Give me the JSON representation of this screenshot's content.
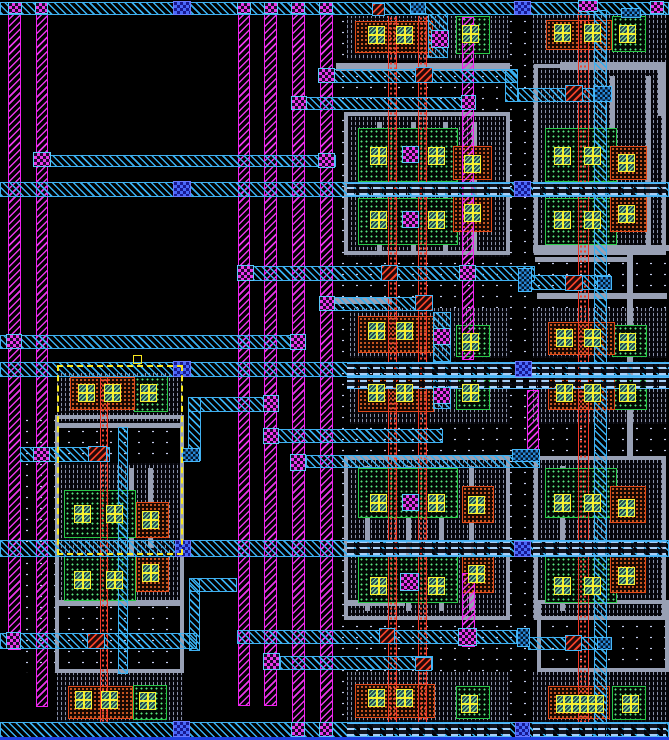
{
  "app": {
    "name": "ic-layout-editor-viewport",
    "tool": "vlsi-layout-canvas"
  },
  "canvas": {
    "width": 669,
    "height": 740,
    "background": "#000000"
  },
  "palette": {
    "metal1_magenta": "#e838e8",
    "metal2_cyan": "#38b0f0",
    "via12_checker": "#e838e8",
    "via_dark_blue": "#4868f8",
    "contact_red": "#f04028",
    "diff_contact_yellow": "#f8f030",
    "ndiff_green": "#58e880",
    "implant_orange": "#f06828",
    "poly_red": "#f04838",
    "gate_gray": "#98a0b4",
    "well_dot": "#c8d0f0",
    "selection_yellow": "#f8e820",
    "bottom_rail_blue": "#2040e0"
  },
  "legend": {
    "m1": "vertical metal1 power rail (magenta hatch)",
    "m2": "metal2 routing (cyan hatch)",
    "m2d": "metal2 over cell (dashed render)",
    "via-m": "metal1-metal2 via (magenta checker)",
    "via-b": "stacked via (dark blue checker)",
    "via-r": "poly contact via (red hatch)",
    "jbox": "metal junction box",
    "cont": "diffusion contact (yellow cross)",
    "diff": "n/p diffusion (green dots)",
    "imp": "implant region (orange dots)",
    "rpoly": "poly column (red dots)",
    "ptex": "gate poly texture",
    "gray": "gate/field structure",
    "well": "well stipple",
    "sel": "selection box (yellow dashed)"
  },
  "selection": {
    "x": 57,
    "y": 365,
    "w": 126,
    "h": 190,
    "handle": [
      133,
      355
    ]
  },
  "shapes": [
    [
      "well",
      336,
      16,
      333,
      706
    ],
    [
      "well",
      20,
      415,
      164,
      258
    ],
    [
      "ptex",
      347,
      16,
      163,
      44
    ],
    [
      "ptex",
      533,
      13,
      134,
      52
    ],
    [
      "ptex",
      347,
      112,
      163,
      145
    ],
    [
      "ptex",
      533,
      64,
      133,
      191
    ],
    [
      "ptex",
      350,
      308,
      160,
      50
    ],
    [
      "ptex",
      533,
      308,
      134,
      50
    ],
    [
      "ptex",
      350,
      377,
      160,
      47
    ],
    [
      "ptex",
      533,
      377,
      134,
      47
    ],
    [
      "ptex",
      347,
      456,
      163,
      164
    ],
    [
      "ptex",
      533,
      456,
      133,
      164
    ],
    [
      "ptex",
      347,
      672,
      163,
      50
    ],
    [
      "ptex",
      533,
      672,
      136,
      50
    ],
    [
      "ptex",
      57,
      373,
      126,
      50
    ],
    [
      "ptex",
      57,
      463,
      126,
      92
    ],
    [
      "ptex",
      57,
      555,
      126,
      47
    ],
    [
      "ptex",
      57,
      673,
      126,
      49
    ],
    [
      "grayframe",
      344,
      112,
      166,
      143
    ],
    [
      "gray",
      377,
      122,
      5,
      130
    ],
    [
      "gray",
      411,
      122,
      5,
      130
    ],
    [
      "gray",
      443,
      122,
      5,
      130
    ],
    [
      "gray",
      472,
      122,
      5,
      130
    ],
    [
      "grayframe",
      344,
      456,
      166,
      164
    ],
    [
      "gray",
      365,
      466,
      5,
      145
    ],
    [
      "gray",
      406,
      466,
      5,
      145
    ],
    [
      "gray",
      439,
      466,
      5,
      145
    ],
    [
      "gray",
      469,
      466,
      5,
      145
    ],
    [
      "grayframe",
      534,
      64,
      132,
      191
    ],
    [
      "gray",
      610,
      76,
      5,
      170
    ],
    [
      "gray",
      646,
      76,
      5,
      170
    ],
    [
      "grayframe",
      534,
      456,
      132,
      164
    ],
    [
      "gray",
      560,
      466,
      5,
      145
    ],
    [
      "gray",
      627,
      252,
      6,
      204
    ],
    [
      "gray",
      533,
      245,
      136,
      6
    ],
    [
      "gray",
      535,
      257,
      97,
      5
    ],
    [
      "gray",
      336,
      63,
      174,
      8
    ],
    [
      "gray",
      560,
      62,
      106,
      8
    ],
    [
      "gray",
      658,
      62,
      8,
      54
    ],
    [
      "gray",
      330,
      298,
      62,
      6
    ],
    [
      "gray",
      537,
      293,
      130,
      6
    ],
    [
      "grayframe",
      537,
      600,
      132,
      72
    ],
    [
      "gray",
      345,
      600,
      60,
      6
    ],
    [
      "grayframe",
      55,
      415,
      129,
      258
    ],
    [
      "gray",
      55,
      423,
      129,
      5
    ],
    [
      "gray",
      57,
      600,
      126,
      6
    ],
    [
      "gray",
      129,
      468,
      5,
      132
    ],
    [
      "gray",
      148,
      468,
      5,
      80
    ],
    [
      "diff",
      456,
      16,
      34,
      38
    ],
    [
      "diff",
      358,
      128,
      100,
      54
    ],
    [
      "diff",
      358,
      198,
      100,
      47
    ],
    [
      "diff",
      456,
      325,
      34,
      32
    ],
    [
      "diff",
      456,
      377,
      34,
      33
    ],
    [
      "diff",
      358,
      468,
      100,
      50
    ],
    [
      "diff",
      358,
      556,
      100,
      47
    ],
    [
      "diff",
      456,
      686,
      34,
      33
    ],
    [
      "diff",
      612,
      16,
      34,
      36
    ],
    [
      "diff",
      545,
      128,
      72,
      54
    ],
    [
      "diff",
      545,
      198,
      72,
      47
    ],
    [
      "diff",
      612,
      325,
      35,
      32
    ],
    [
      "diff",
      612,
      377,
      35,
      33
    ],
    [
      "diff",
      545,
      468,
      72,
      50
    ],
    [
      "diff",
      545,
      556,
      72,
      47
    ],
    [
      "diff",
      612,
      686,
      34,
      34
    ],
    [
      "diff",
      134,
      376,
      34,
      36
    ],
    [
      "diff",
      64,
      490,
      72,
      48
    ],
    [
      "diff",
      64,
      556,
      72,
      45
    ],
    [
      "diff",
      133,
      685,
      34,
      35
    ],
    [
      "imp",
      355,
      21,
      78,
      32
    ],
    [
      "imp",
      358,
      316,
      76,
      37
    ],
    [
      "imp",
      358,
      377,
      76,
      35
    ],
    [
      "imp",
      355,
      684,
      80,
      34
    ],
    [
      "imp",
      546,
      20,
      66,
      30
    ],
    [
      "imp",
      548,
      322,
      67,
      33
    ],
    [
      "imp",
      548,
      377,
      67,
      33
    ],
    [
      "imp",
      548,
      686,
      62,
      33
    ],
    [
      "imp",
      70,
      377,
      65,
      33
    ],
    [
      "imp",
      68,
      686,
      65,
      33
    ],
    [
      "imp",
      453,
      146,
      39,
      34
    ],
    [
      "imp",
      453,
      196,
      39,
      36
    ],
    [
      "imp",
      462,
      486,
      32,
      37
    ],
    [
      "imp",
      462,
      556,
      32,
      37
    ],
    [
      "imp",
      610,
      146,
      37,
      34
    ],
    [
      "imp",
      610,
      196,
      37,
      36
    ],
    [
      "imp",
      610,
      486,
      36,
      37
    ],
    [
      "imp",
      610,
      556,
      36,
      37
    ],
    [
      "imp",
      136,
      502,
      33,
      36
    ],
    [
      "imp",
      136,
      556,
      33,
      36
    ],
    [
      "rpoly",
      388,
      16,
      9,
      706
    ],
    [
      "rpoly",
      418,
      16,
      9,
      706
    ],
    [
      "rpoly",
      578,
      4,
      11,
      718
    ],
    [
      "rpoly",
      100,
      378,
      8,
      344
    ],
    [
      "m1",
      8,
      3,
      13,
      647
    ],
    [
      "m1",
      36,
      3,
      12,
      704
    ],
    [
      "m1",
      238,
      3,
      12,
      703
    ],
    [
      "m1",
      264,
      3,
      13,
      703
    ],
    [
      "m1",
      292,
      3,
      13,
      735
    ],
    [
      "m1",
      320,
      3,
      13,
      735
    ],
    [
      "m1",
      462,
      17,
      12,
      343
    ],
    [
      "m1",
      462,
      573,
      13,
      74
    ],
    [
      "m1",
      527,
      390,
      12,
      72
    ],
    [
      "m2",
      0,
      2,
      669,
      13
    ],
    [
      "m2",
      328,
      69,
      190,
      14
    ],
    [
      "m2",
      505,
      69,
      13,
      33
    ],
    [
      "m2",
      518,
      88,
      76,
      14
    ],
    [
      "m2",
      298,
      97,
      167,
      13
    ],
    [
      "m2",
      40,
      155,
      296,
      12
    ],
    [
      "m2",
      0,
      182,
      669,
      15
    ],
    [
      "m2",
      245,
      266,
      290,
      15
    ],
    [
      "m2",
      531,
      275,
      80,
      15
    ],
    [
      "m2",
      328,
      297,
      105,
      14
    ],
    [
      "m2",
      0,
      335,
      305,
      14
    ],
    [
      "m2",
      0,
      362,
      669,
      15
    ],
    [
      "m2",
      188,
      397,
      90,
      15
    ],
    [
      "m2",
      277,
      429,
      166,
      14
    ],
    [
      "m2",
      306,
      455,
      234,
      13
    ],
    [
      "m2",
      20,
      447,
      90,
      15
    ],
    [
      "m2",
      0,
      540,
      669,
      17
    ],
    [
      "m2",
      189,
      578,
      48,
      14
    ],
    [
      "m2",
      0,
      633,
      197,
      16
    ],
    [
      "m2",
      237,
      630,
      280,
      14
    ],
    [
      "m2",
      528,
      637,
      84,
      13
    ],
    [
      "m2",
      280,
      656,
      153,
      14
    ],
    [
      "m2",
      0,
      722,
      669,
      16
    ],
    [
      "m2",
      594,
      10,
      13,
      727
    ],
    [
      "m2",
      428,
      14,
      20,
      44
    ],
    [
      "m2",
      433,
      312,
      18,
      50
    ],
    [
      "m2",
      433,
      377,
      18,
      32
    ],
    [
      "m2",
      118,
      427,
      10,
      247
    ],
    [
      "m2",
      188,
      397,
      13,
      64
    ],
    [
      "m2",
      189,
      578,
      11,
      73
    ],
    [
      "m2d",
      347,
      183,
      163,
      13
    ],
    [
      "m2d",
      533,
      183,
      133,
      13
    ],
    [
      "m2d",
      347,
      363,
      322,
      13
    ],
    [
      "m2d",
      347,
      377,
      322,
      12
    ],
    [
      "m2d",
      347,
      541,
      163,
      15
    ],
    [
      "m2d",
      533,
      541,
      133,
      15
    ],
    [
      "m2d",
      347,
      723,
      163,
      14
    ],
    [
      "m2d",
      533,
      723,
      133,
      14
    ],
    [
      "via-m",
      8,
      2,
      14,
      12
    ],
    [
      "via-m",
      35,
      2,
      13,
      12
    ],
    [
      "via-m",
      237,
      2,
      14,
      12
    ],
    [
      "via-m",
      264,
      2,
      14,
      12
    ],
    [
      "via-m",
      291,
      2,
      14,
      12
    ],
    [
      "via-m",
      319,
      2,
      14,
      12
    ],
    [
      "via-m",
      650,
      1,
      14,
      13
    ],
    [
      "via-m",
      578,
      0,
      20,
      12
    ],
    [
      "via-r",
      372,
      3,
      13,
      13
    ],
    [
      "jbox",
      410,
      2,
      16,
      12
    ],
    [
      "jbox",
      621,
      8,
      20,
      10
    ],
    [
      "via-b",
      173,
      1,
      18,
      14
    ],
    [
      "via-b",
      514,
      1,
      17,
      14
    ],
    [
      "via-m",
      318,
      68,
      17,
      15
    ],
    [
      "via-r",
      415,
      67,
      18,
      16
    ],
    [
      "via-r",
      565,
      85,
      18,
      17
    ],
    [
      "jbox",
      594,
      86,
      18,
      16
    ],
    [
      "via-m",
      291,
      96,
      16,
      14
    ],
    [
      "via-m",
      461,
      95,
      15,
      15
    ],
    [
      "via-m",
      33,
      152,
      18,
      15
    ],
    [
      "via-m",
      318,
      153,
      17,
      15
    ],
    [
      "via-b",
      173,
      181,
      18,
      16
    ],
    [
      "via-b",
      514,
      181,
      17,
      16
    ],
    [
      "via-m",
      237,
      265,
      17,
      16
    ],
    [
      "via-r",
      381,
      265,
      17,
      16
    ],
    [
      "via-m",
      459,
      265,
      17,
      16
    ],
    [
      "jbox",
      518,
      268,
      14,
      24
    ],
    [
      "via-r",
      565,
      275,
      18,
      16
    ],
    [
      "jbox",
      597,
      276,
      15,
      14
    ],
    [
      "via-m",
      319,
      296,
      16,
      15
    ],
    [
      "via-r",
      415,
      295,
      18,
      16
    ],
    [
      "via-m",
      6,
      334,
      16,
      15
    ],
    [
      "via-m",
      290,
      334,
      16,
      16
    ],
    [
      "via-b",
      173,
      361,
      18,
      16
    ],
    [
      "via-b",
      515,
      361,
      17,
      16
    ],
    [
      "via-m",
      263,
      395,
      16,
      17
    ],
    [
      "via-m",
      263,
      428,
      16,
      16
    ],
    [
      "via-m",
      290,
      454,
      16,
      17
    ],
    [
      "jbox",
      512,
      449,
      28,
      13
    ],
    [
      "via-m",
      33,
      447,
      17,
      15
    ],
    [
      "via-r",
      88,
      446,
      19,
      16
    ],
    [
      "jbox",
      182,
      448,
      18,
      14
    ],
    [
      "via-b",
      175,
      540,
      16,
      17
    ],
    [
      "via-b",
      514,
      541,
      17,
      16
    ],
    [
      "via-m",
      431,
      30,
      18,
      18
    ],
    [
      "via-m",
      402,
      146,
      17,
      17
    ],
    [
      "via-m",
      402,
      211,
      17,
      17
    ],
    [
      "via-m",
      433,
      328,
      18,
      17
    ],
    [
      "via-m",
      433,
      387,
      18,
      17
    ],
    [
      "via-m",
      402,
      494,
      17,
      17
    ],
    [
      "via-m",
      400,
      573,
      19,
      18
    ],
    [
      "via-m",
      6,
      632,
      15,
      17
    ],
    [
      "via-r",
      87,
      633,
      18,
      16
    ],
    [
      "via-r",
      379,
      628,
      16,
      16
    ],
    [
      "via-m",
      458,
      628,
      19,
      18
    ],
    [
      "jbox",
      517,
      628,
      13,
      19
    ],
    [
      "via-r",
      565,
      635,
      17,
      16
    ],
    [
      "jbox",
      597,
      637,
      15,
      13
    ],
    [
      "via-m",
      263,
      653,
      17,
      17
    ],
    [
      "via-r",
      415,
      657,
      17,
      14
    ],
    [
      "via-b",
      173,
      721,
      17,
      16
    ],
    [
      "via-b",
      515,
      722,
      15,
      15
    ],
    [
      "via-m",
      291,
      722,
      14,
      15
    ],
    [
      "via-m",
      319,
      722,
      14,
      15
    ],
    [
      "cont",
      368,
      26,
      17,
      18
    ],
    [
      "cont",
      396,
      26,
      17,
      18
    ],
    [
      "cont",
      462,
      25,
      17,
      18
    ],
    [
      "cont",
      370,
      147,
      17,
      18
    ],
    [
      "cont",
      428,
      147,
      17,
      18
    ],
    [
      "cont",
      464,
      155,
      17,
      18
    ],
    [
      "cont",
      370,
      211,
      17,
      18
    ],
    [
      "cont",
      428,
      211,
      17,
      18
    ],
    [
      "cont",
      464,
      204,
      17,
      18
    ],
    [
      "cont",
      368,
      322,
      17,
      18
    ],
    [
      "cont",
      396,
      322,
      17,
      18
    ],
    [
      "cont",
      462,
      333,
      17,
      18
    ],
    [
      "cont",
      368,
      384,
      17,
      18
    ],
    [
      "cont",
      396,
      384,
      17,
      18
    ],
    [
      "cont",
      462,
      384,
      17,
      18
    ],
    [
      "cont",
      370,
      494,
      17,
      18
    ],
    [
      "cont",
      428,
      494,
      17,
      18
    ],
    [
      "cont",
      468,
      496,
      17,
      18
    ],
    [
      "cont",
      370,
      577,
      17,
      18
    ],
    [
      "cont",
      428,
      577,
      17,
      18
    ],
    [
      "cont",
      468,
      565,
      17,
      18
    ],
    [
      "cont",
      368,
      689,
      17,
      18
    ],
    [
      "cont",
      396,
      689,
      17,
      18
    ],
    [
      "cont",
      461,
      695,
      17,
      18
    ],
    [
      "cont",
      554,
      24,
      17,
      18
    ],
    [
      "cont",
      584,
      24,
      17,
      18
    ],
    [
      "cont",
      619,
      25,
      17,
      18
    ],
    [
      "cont",
      554,
      147,
      17,
      18
    ],
    [
      "cont",
      584,
      147,
      17,
      18
    ],
    [
      "cont",
      618,
      154,
      17,
      18
    ],
    [
      "cont",
      554,
      211,
      17,
      18
    ],
    [
      "cont",
      584,
      211,
      17,
      18
    ],
    [
      "cont",
      618,
      205,
      17,
      18
    ],
    [
      "cont",
      556,
      329,
      17,
      18
    ],
    [
      "cont",
      584,
      329,
      17,
      18
    ],
    [
      "cont",
      619,
      333,
      17,
      18
    ],
    [
      "cont",
      556,
      384,
      17,
      18
    ],
    [
      "cont",
      584,
      384,
      17,
      18
    ],
    [
      "cont",
      619,
      384,
      17,
      18
    ],
    [
      "cont",
      554,
      494,
      17,
      18
    ],
    [
      "cont",
      584,
      494,
      17,
      18
    ],
    [
      "cont",
      618,
      499,
      17,
      18
    ],
    [
      "cont",
      554,
      577,
      17,
      18
    ],
    [
      "cont",
      584,
      577,
      17,
      18
    ],
    [
      "cont",
      618,
      567,
      17,
      18
    ],
    [
      "cont",
      556,
      695,
      16,
      18
    ],
    [
      "cont",
      572,
      695,
      16,
      18
    ],
    [
      "cont",
      588,
      695,
      16,
      18
    ],
    [
      "cont",
      622,
      695,
      17,
      18
    ],
    [
      "cont",
      78,
      384,
      17,
      18
    ],
    [
      "cont",
      104,
      384,
      17,
      18
    ],
    [
      "cont",
      140,
      384,
      17,
      18
    ],
    [
      "cont",
      74,
      505,
      17,
      18
    ],
    [
      "cont",
      106,
      505,
      17,
      18
    ],
    [
      "cont",
      142,
      511,
      17,
      18
    ],
    [
      "cont",
      74,
      571,
      17,
      18
    ],
    [
      "cont",
      106,
      571,
      17,
      18
    ],
    [
      "cont",
      142,
      564,
      17,
      18
    ],
    [
      "cont",
      75,
      691,
      17,
      18
    ],
    [
      "cont",
      101,
      691,
      17,
      18
    ],
    [
      "cont",
      139,
      692,
      17,
      18
    ],
    [
      "sel",
      57,
      365,
      126,
      190
    ],
    [
      "sel-sq",
      133,
      355,
      9,
      9
    ],
    [
      "bluebar",
      0,
      737,
      669,
      3
    ]
  ]
}
